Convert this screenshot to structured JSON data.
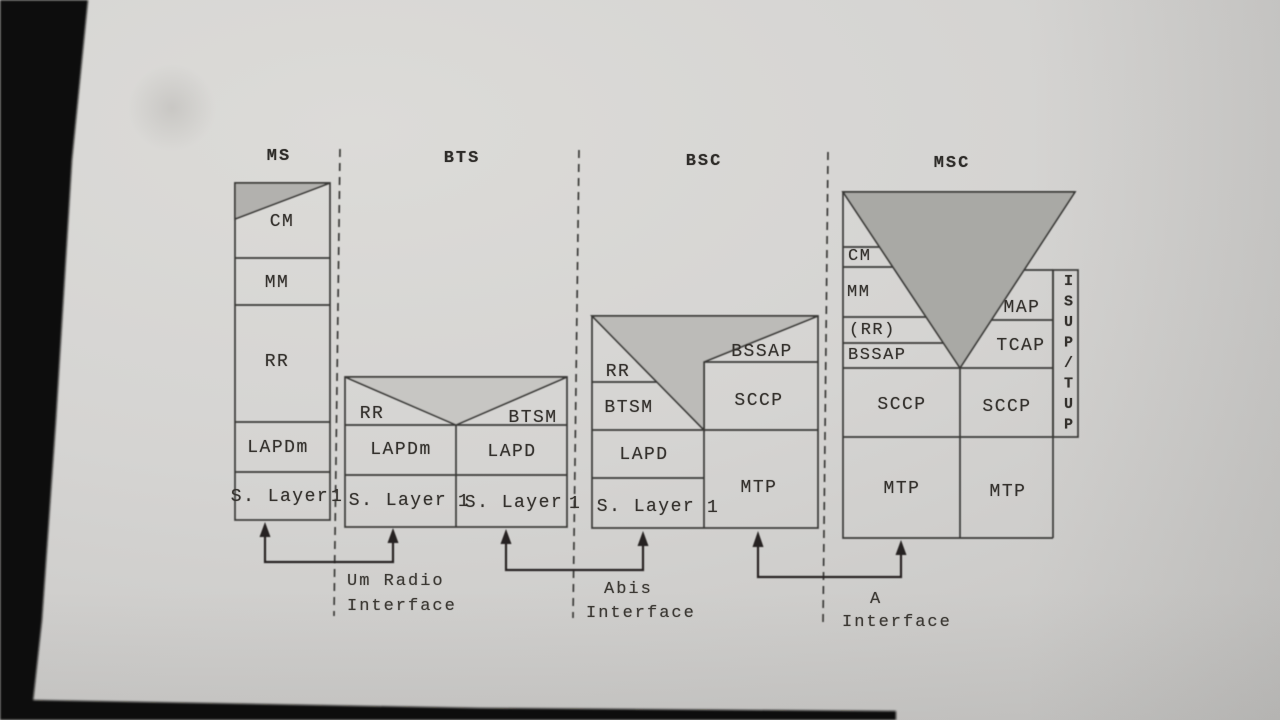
{
  "photo": {
    "bezel_color": "#0c0b09",
    "paper_color": "#d2d1cf",
    "line_color": "#3b3a38",
    "shade_light": "#c7c6c3",
    "shade_mid": "#bcbbb8",
    "shade_dark": "#a9a9a5",
    "shade_ms": "#b2b1ae"
  },
  "columns": {
    "ms": {
      "header": "MS",
      "cm": "CM",
      "mm": "MM",
      "rr": "RR",
      "lapdm": "LAPDm",
      "layer1": "S. Layer",
      "layer1_num": "1"
    },
    "bts": {
      "header": "BTS",
      "rr": "RR",
      "btsm": "BTSM",
      "lapdm": "LAPDm",
      "lapd": "LAPD",
      "layer1_left": "S. Layer",
      "layer1_left_num": "1",
      "layer1_right": "S. Layer",
      "layer1_right_num": "1"
    },
    "bsc": {
      "header": "BSC",
      "rr": "RR",
      "btsm": "BTSM",
      "bssap": "BSSAP",
      "sccp": "SCCP",
      "lapd": "LAPD",
      "layer1": "S. Layer",
      "layer1_num": "1",
      "mtp": "MTP"
    },
    "msc": {
      "header": "MSC",
      "cm": "CM",
      "mm": "MM",
      "rr": "(RR)",
      "bssap": "BSSAP",
      "map": "MAP",
      "tcap": "TCAP",
      "sccp_left": "SCCP",
      "sccp_right": "SCCP",
      "mtp_left": "MTP",
      "mtp_right": "MTP",
      "isup_tup": "ISUP/TUP"
    }
  },
  "interfaces": {
    "um": {
      "line1": "Um Radio",
      "line2": "Interface"
    },
    "abis": {
      "line1": "Abis",
      "line2": "Interface"
    },
    "a": {
      "line1": "A",
      "line2": "Interface"
    }
  }
}
